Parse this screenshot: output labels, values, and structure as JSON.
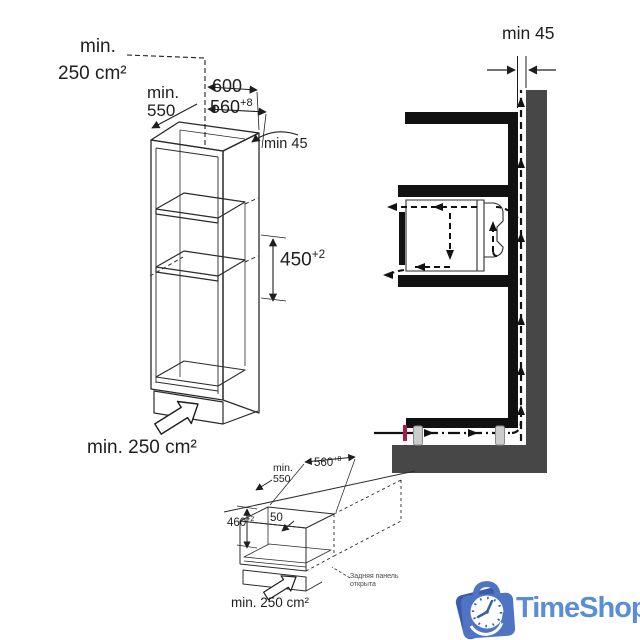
{
  "colors": {
    "line": "#2b2b2b",
    "section_black": "#111111",
    "wall_gray": "#474747",
    "accent_red": "#b0164a",
    "foot_gray": "#cccccc",
    "logo_dark_blue": "#3b5cac",
    "logo_blue": "#4e74c2",
    "logo_text_blue": "#5a8dd2"
  },
  "cabinet_diagram": {
    "top_vent": {
      "line1": "min.",
      "line2": "250 cm²"
    },
    "depth": {
      "line1": "min.",
      "line2": "550"
    },
    "width": "600",
    "niche_width": {
      "value": "560",
      "tolerance": "+8"
    },
    "rear_gap": "min 45",
    "niche_height": {
      "value": "450",
      "tolerance": "+2"
    },
    "bottom_vent": "min. 250 cm²"
  },
  "airflow_diagram": {
    "rear_gap": "min 45"
  },
  "niche_diagram": {
    "depth": {
      "line1": "min.",
      "line2": "550"
    },
    "width": {
      "value": "560",
      "tolerance": "+8"
    },
    "height": {
      "value": "460",
      "tolerance": "+2"
    },
    "front_gap": "50",
    "vent": "min. 250 cm²",
    "note": {
      "line1": "Задняя панель",
      "line2": "открыта"
    }
  },
  "logo": {
    "text": "TimeShop"
  }
}
